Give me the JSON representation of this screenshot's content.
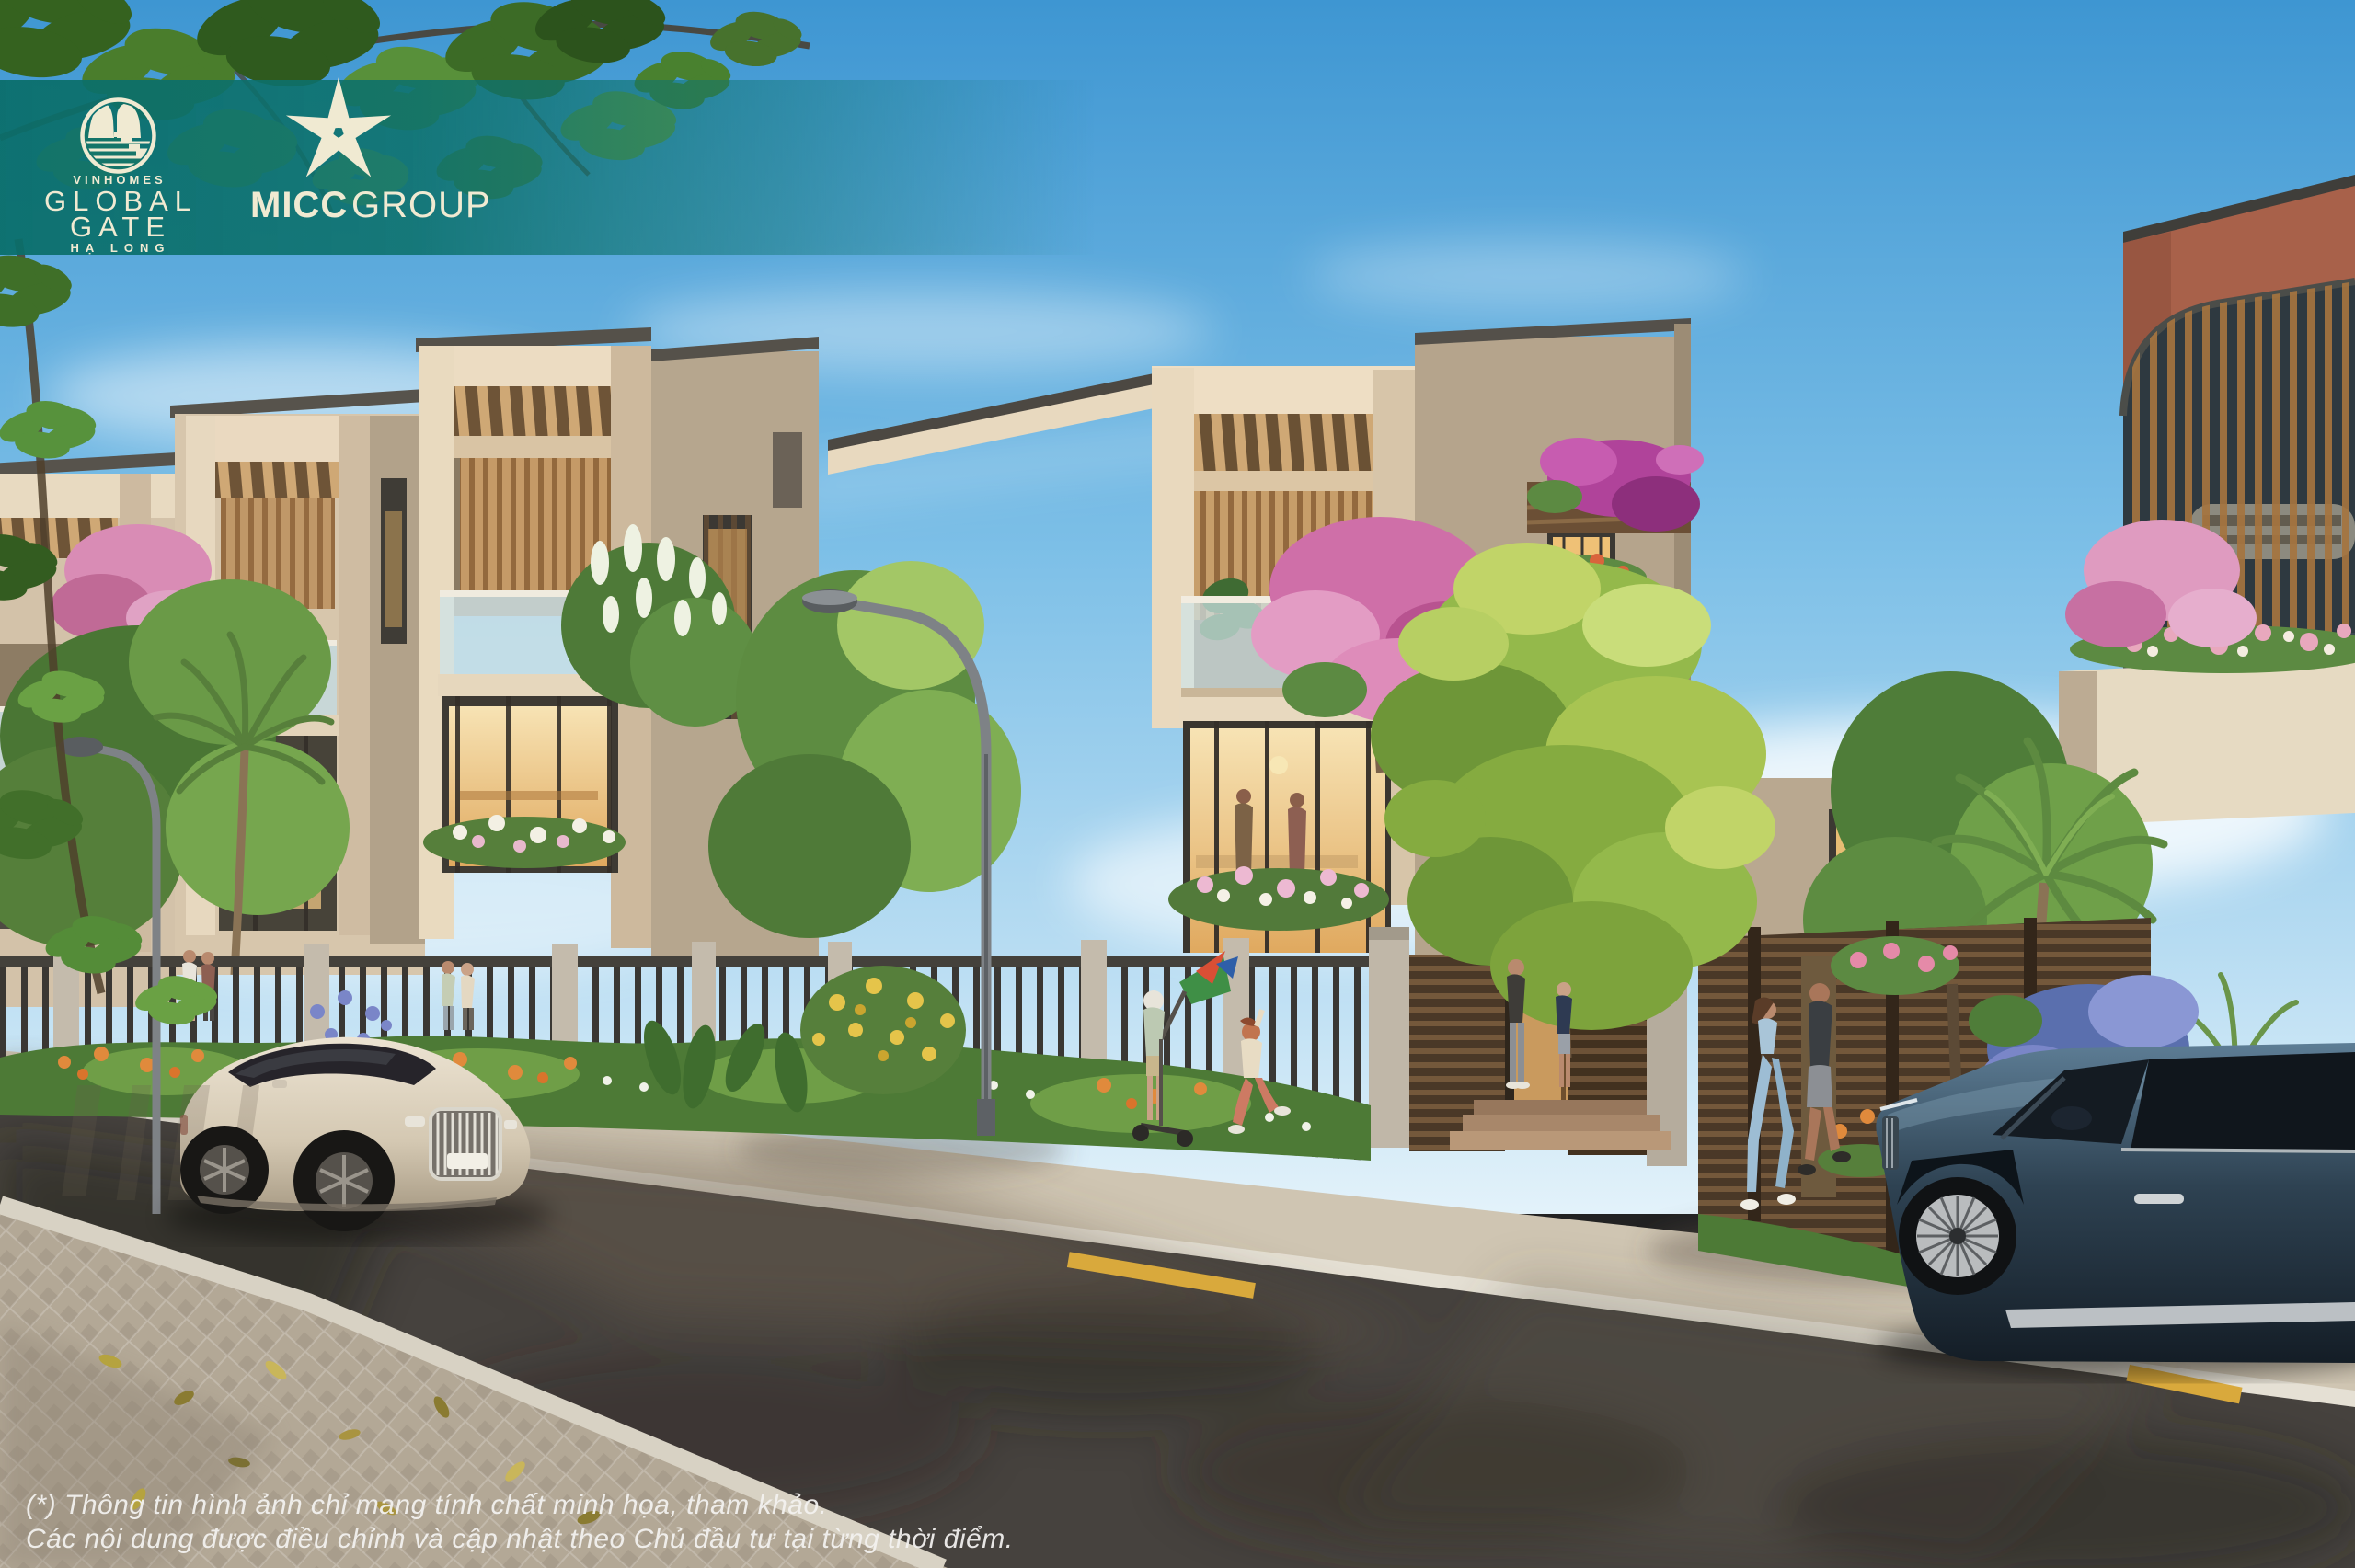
{
  "branding": {
    "vinhomes": {
      "brand": "VINHOMES",
      "title_line1": "GLOBAL",
      "title_line2": "GATE",
      "location": "HẠ LONG"
    },
    "micc": {
      "bold": "MICC",
      "regular": "GROUP"
    }
  },
  "disclaimer": {
    "line1": "(*) Thông tin hình ảnh chỉ mang tính chất minh họa, tham khảo.",
    "line2": "Các nội dung được điều chỉnh và cập nhật theo Chủ đầu tư tại từng thời điểm."
  },
  "palette": {
    "brand_teal": "#0c6f6b",
    "logo_cream": "#f0ead2",
    "sky_blue": "#5aa7dc",
    "villa_cream": "#dfcfb6",
    "foliage_green": "#6fa049",
    "road_asphalt": "#46423e",
    "marking_yellow": "#d9a93c"
  }
}
